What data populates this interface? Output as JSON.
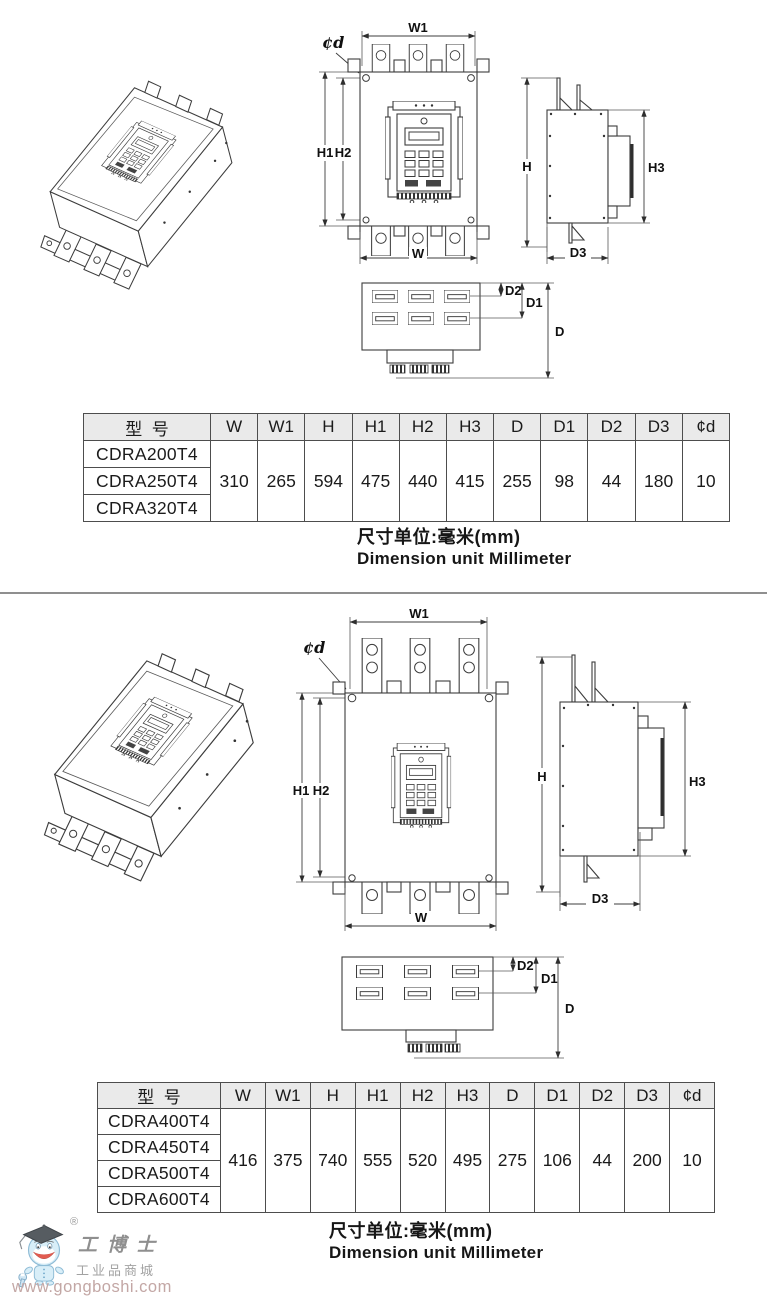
{
  "dim_labels": {
    "w1": "W1",
    "phid": "¢d",
    "h1": "H1",
    "h2": "H2",
    "w": "W",
    "h": "H",
    "h3": "H3",
    "d3": "D3",
    "d2": "D2",
    "d1": "D1",
    "d": "D"
  },
  "tables": {
    "headers": [
      "型  号",
      "W",
      "W1",
      "H",
      "H1",
      "H2",
      "H3",
      "D",
      "D1",
      "D2",
      "D3",
      "¢d"
    ],
    "table1": {
      "models": [
        "CDRA200T4",
        "CDRA250T4",
        "CDRA320T4"
      ],
      "values": [
        "310",
        "265",
        "594",
        "475",
        "440",
        "415",
        "255",
        "98",
        "44",
        "180",
        "10"
      ]
    },
    "table2": {
      "models": [
        "CDRA400T4",
        "CDRA450T4",
        "CDRA500T4",
        "CDRA600T4"
      ],
      "values": [
        "416",
        "375",
        "740",
        "555",
        "520",
        "495",
        "275",
        "106",
        "44",
        "200",
        "10"
      ]
    }
  },
  "captions": {
    "cn": "尺寸单位:毫米(mm)",
    "en": "Dimension unit Millimeter"
  },
  "watermark": {
    "reg": "®",
    "brand": "工博士",
    "sub": "工业品商城",
    "url": "www.gongboshi.com"
  },
  "colors": {
    "table_header_bg": "#eaeaea",
    "line": "#3c3c3c",
    "mascot_blue": "#d8eef8",
    "url_text": "#c3a7a5"
  }
}
